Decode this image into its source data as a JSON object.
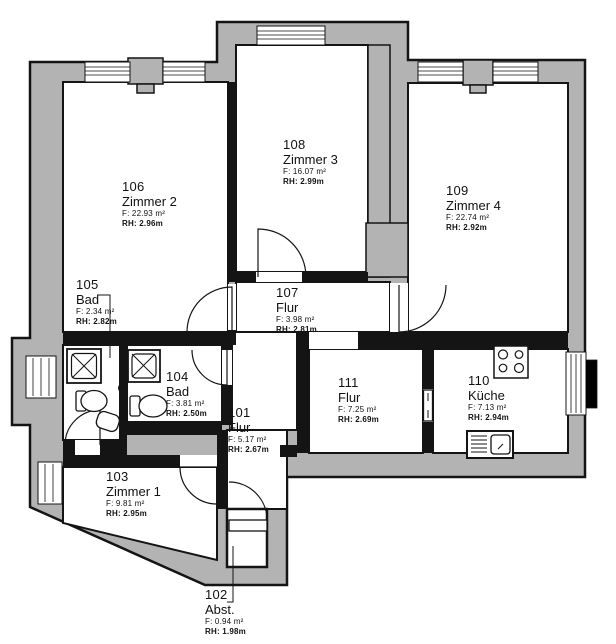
{
  "plan": {
    "title": "Apartment floor plan",
    "rooms": [
      {
        "number": "101",
        "name": "Flur",
        "area": "F: 5.17 m²",
        "height": "RH: 2.67m"
      },
      {
        "number": "102",
        "name": "Abst.",
        "area": "F: 0.94 m²",
        "height": "RH: 1.98m"
      },
      {
        "number": "103",
        "name": "Zimmer 1",
        "area": "F: 9.81 m²",
        "height": "RH: 2.95m"
      },
      {
        "number": "104",
        "name": "Bad",
        "area": "F: 3.81 m²",
        "height": "RH: 2.50m"
      },
      {
        "number": "105",
        "name": "Bad",
        "area": "F: 2.34 m²",
        "height": "RH: 2.82m"
      },
      {
        "number": "106",
        "name": "Zimmer 2",
        "area": "F: 22.93 m²",
        "height": "RH: 2.96m"
      },
      {
        "number": "107",
        "name": "Flur",
        "area": "F: 3.98 m²",
        "height": "RH: 2.81m"
      },
      {
        "number": "108",
        "name": "Zimmer 3",
        "area": "F: 16.07 m²",
        "height": "RH: 2.99m"
      },
      {
        "number": "109",
        "name": "Zimmer 4",
        "area": "F: 22.74 m²",
        "height": "RH: 2.92m"
      },
      {
        "number": "110",
        "name": "Küche",
        "area": "F: 7.13 m²",
        "height": "RH: 2.94m"
      },
      {
        "number": "111",
        "name": "Flur",
        "area": "F: 7.25 m²",
        "height": "RH: 2.69m"
      }
    ],
    "colors": {
      "wall_fill": "#b3b3b3",
      "line": "#141414",
      "background": "#ffffff"
    }
  }
}
